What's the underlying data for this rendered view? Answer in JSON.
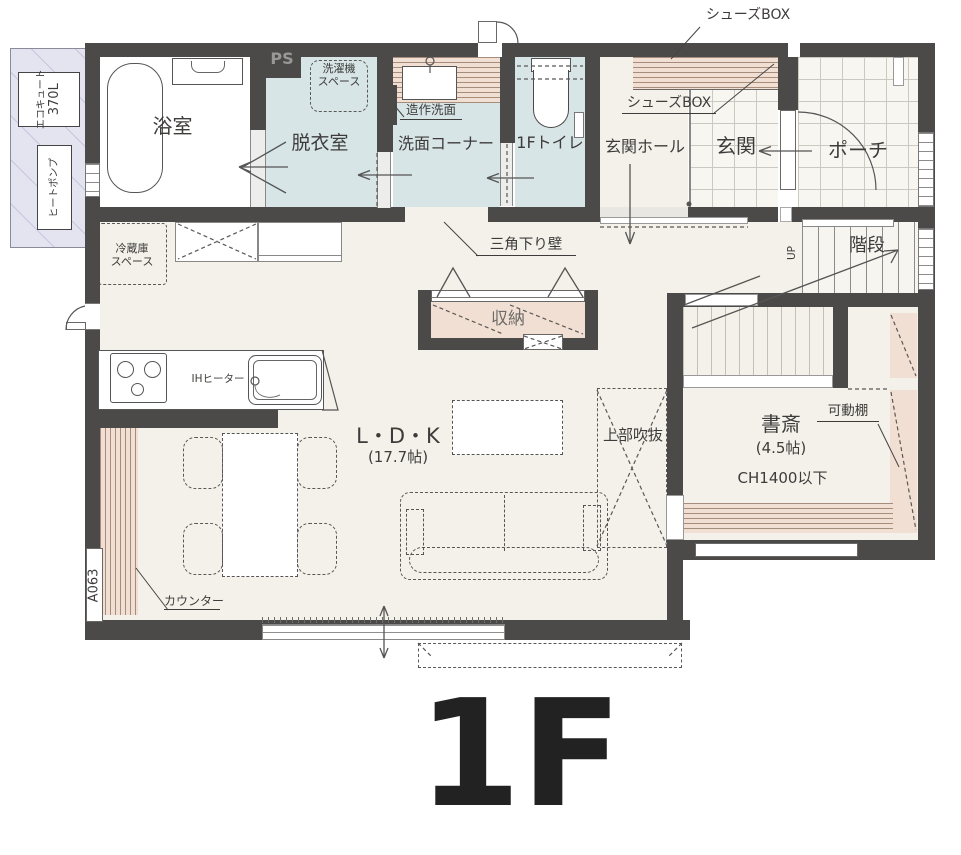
{
  "floor": {
    "label": "1F"
  },
  "rooms": {
    "bath": "浴室",
    "dressing_room": "脱衣室",
    "washroom_corner": "洗面コーナー",
    "toilet": "1Fトイレ",
    "entrance_hall": "玄関ホール",
    "entrance": "玄関",
    "porch": "ポーチ",
    "stairs": "階段",
    "storage": "収納",
    "ldk_name": "L・D・K",
    "ldk_size": "(17.7帖)",
    "study_name": "書斎",
    "study_size": "(4.5帖)",
    "study_ceiling": "CH1400以下",
    "void_above": "上部吹抜"
  },
  "annotations": {
    "ps": "PS",
    "up": "UP",
    "shoes_box_top": "シューズBOX",
    "shoes_box_lower": "シューズBOX",
    "washer_line1": "洗濯機",
    "washer_line2": "スペース",
    "custom_washbasin": "造作洗面",
    "triangle_drop_wall": "三角下り壁",
    "fridge_line1": "冷蔵庫",
    "fridge_line2": "スペース",
    "ih_heater": "IHヒーター",
    "counter": "カウンター",
    "movable_shelf": "可動棚",
    "ecocute_line1": "エコキュート",
    "ecocute_line2": "370L",
    "heat_pump": "ヒートポンプ",
    "window_code": "A063"
  },
  "colors": {
    "wall": "#4c4a49",
    "floor_cream": "#f3f1e9",
    "wet_room_blue": "#d7e5e6",
    "tile_white": "#f7f6f1",
    "furniture_pink": "#f2dfd3",
    "stripe_brown": "#a58c7b",
    "equipment_lavender": "#e4e4f1",
    "label_text": "#3e3c3b"
  }
}
